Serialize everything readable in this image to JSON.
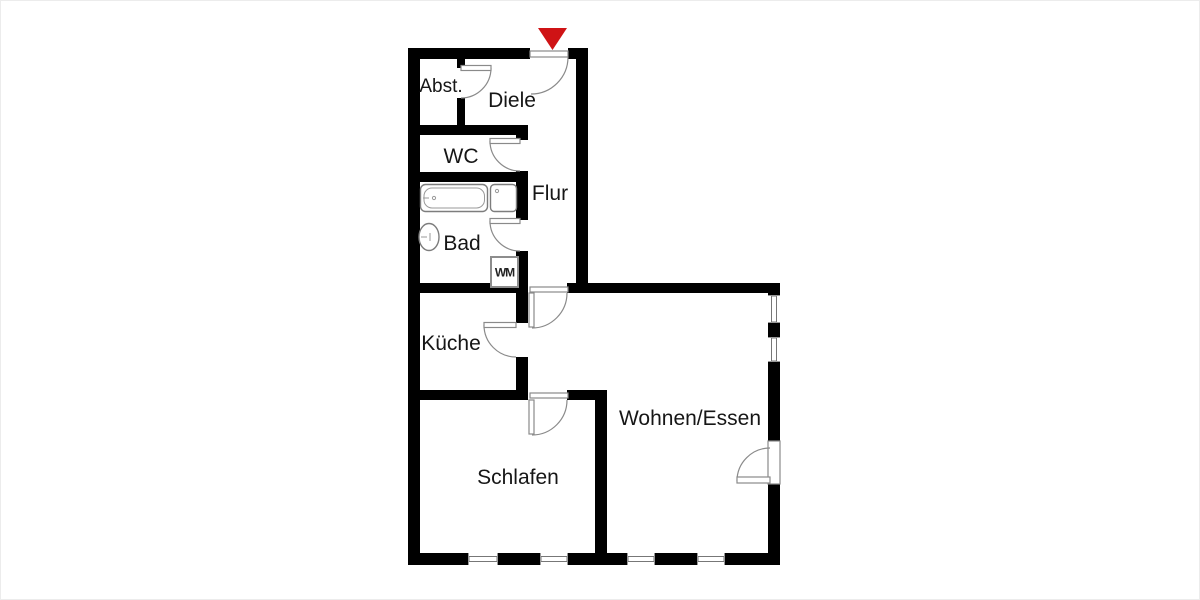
{
  "title": "apartment-floor-plan",
  "colors": {
    "wall": "#000000",
    "line": "#8a8a8a",
    "text": "#161616",
    "entrance_arrow": "#cf1315",
    "entrance_arrow_edge": "#8d0f0f",
    "background": "#ffffff"
  },
  "rooms": {
    "abst": {
      "label": "Abst."
    },
    "diele": {
      "label": "Diele"
    },
    "wc": {
      "label": "WC"
    },
    "flur": {
      "label": "Flur"
    },
    "bad": {
      "label": "Bad"
    },
    "kueche": {
      "label": "Küche"
    },
    "wohnen": {
      "label": "Wohnen/Essen"
    },
    "schlafen": {
      "label": "Schlafen"
    }
  },
  "fixtures": {
    "washing_machine": {
      "label": "WM"
    },
    "bathtub": {
      "name": "bathtub"
    },
    "washbasin": {
      "name": "washbasin"
    },
    "shower_basin": {
      "name": "square-basin"
    }
  },
  "symbols": {
    "entrance_marker": "red-triangle-down"
  }
}
